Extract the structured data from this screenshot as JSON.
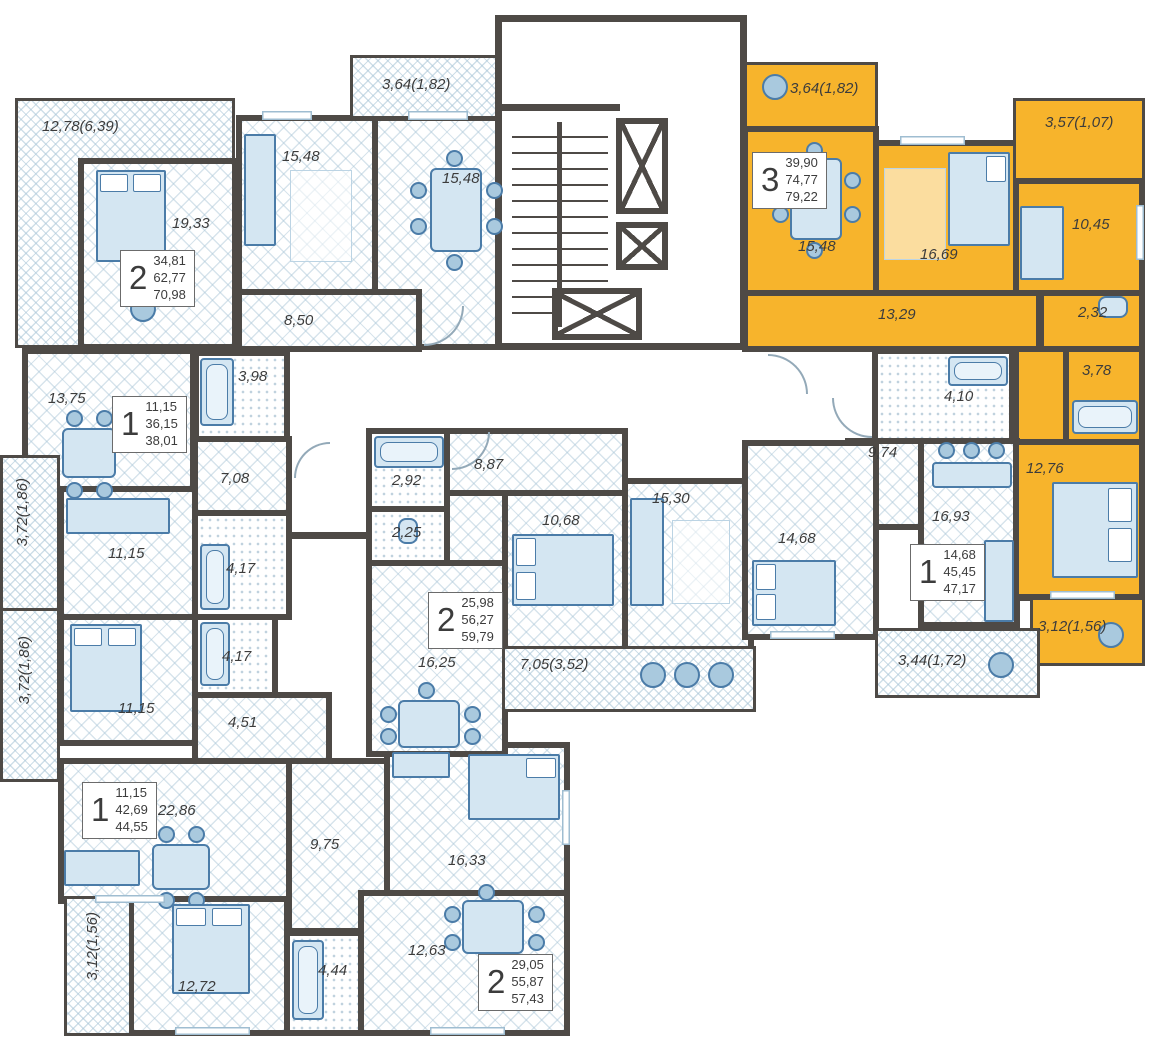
{
  "colors": {
    "highlight_apartment": "#F7B42C",
    "walls": "#4E4A46",
    "furniture_fill": "#D4E6F2",
    "furniture_stroke": "#4B7CA8",
    "label_text": "#3C3C3C"
  },
  "apartments": [
    {
      "key": "top-left",
      "rooms_count": "2",
      "area_living": "34,81",
      "area_total": "62,77",
      "area_full": "70,98"
    },
    {
      "key": "highlighted-3room",
      "rooms_count": "3",
      "area_living": "39,90",
      "area_total": "74,77",
      "area_full": "79,22"
    },
    {
      "key": "mid-left",
      "rooms_count": "1",
      "area_living": "11,15",
      "area_total": "36,15",
      "area_full": "38,01"
    },
    {
      "key": "center",
      "rooms_count": "2",
      "area_living": "25,98",
      "area_total": "56,27",
      "area_full": "59,79"
    },
    {
      "key": "mid-right",
      "rooms_count": "1",
      "area_living": "14,68",
      "area_total": "45,45",
      "area_full": "47,17"
    },
    {
      "key": "bottom-left",
      "rooms_count": "1",
      "area_living": "11,15",
      "area_total": "42,69",
      "area_full": "44,55"
    },
    {
      "key": "bottom-center",
      "rooms_count": "2",
      "area_living": "29,05",
      "area_total": "55,87",
      "area_full": "57,43"
    }
  ],
  "rooms": {
    "a_balcony_left": "12,78(6,39)",
    "a_bedroom": "19,33",
    "a_living": "15,48",
    "a_kitchen": "15,48",
    "a_balcony_top": "3,64(1,82)",
    "a_hall": "8,50",
    "a_bath": "3,98",
    "b_balcony_top": "3,64(1,82)",
    "b_kitchen": "15,48",
    "b_bedroom": "16,69",
    "b_balcony_right": "3,57(1,07)",
    "b_room": "10,45",
    "b_hall": "13,29",
    "b_wc": "2,32",
    "b_bath": "3,78",
    "b_bedroom2": "12,76",
    "b_balcony_bottom": "3,12(1,56)",
    "c_kitchen": "13,75",
    "c_hall": "7,08",
    "c_room": "11,15",
    "c_bath": "4,17",
    "c_balcony": "3,72(1,86)",
    "d_bedroom": "11,15",
    "d_bath": "4,17",
    "d_hall": "4,51",
    "d_living": "22,86",
    "d_balcony": "3,72(1,86)",
    "e_hall": "9,75",
    "e_room": "16,33",
    "e_bedroom": "12,72",
    "e_bath": "4,44",
    "e_kitchen": "12,63",
    "e_balcony": "3,12(1,56)",
    "f_bath": "2,92",
    "f_wc": "2,25",
    "f_hall": "8,87",
    "f_bedroom1": "10,68",
    "f_bedroom2": "15,30",
    "f_kitchen": "16,25",
    "f_balcony": "7,05(3,52)",
    "g_bath": "4,10",
    "g_hall": "9,74",
    "g_kitchen": "16,93",
    "g_room": "14,68",
    "g_balcony": "3,44(1,72)"
  }
}
